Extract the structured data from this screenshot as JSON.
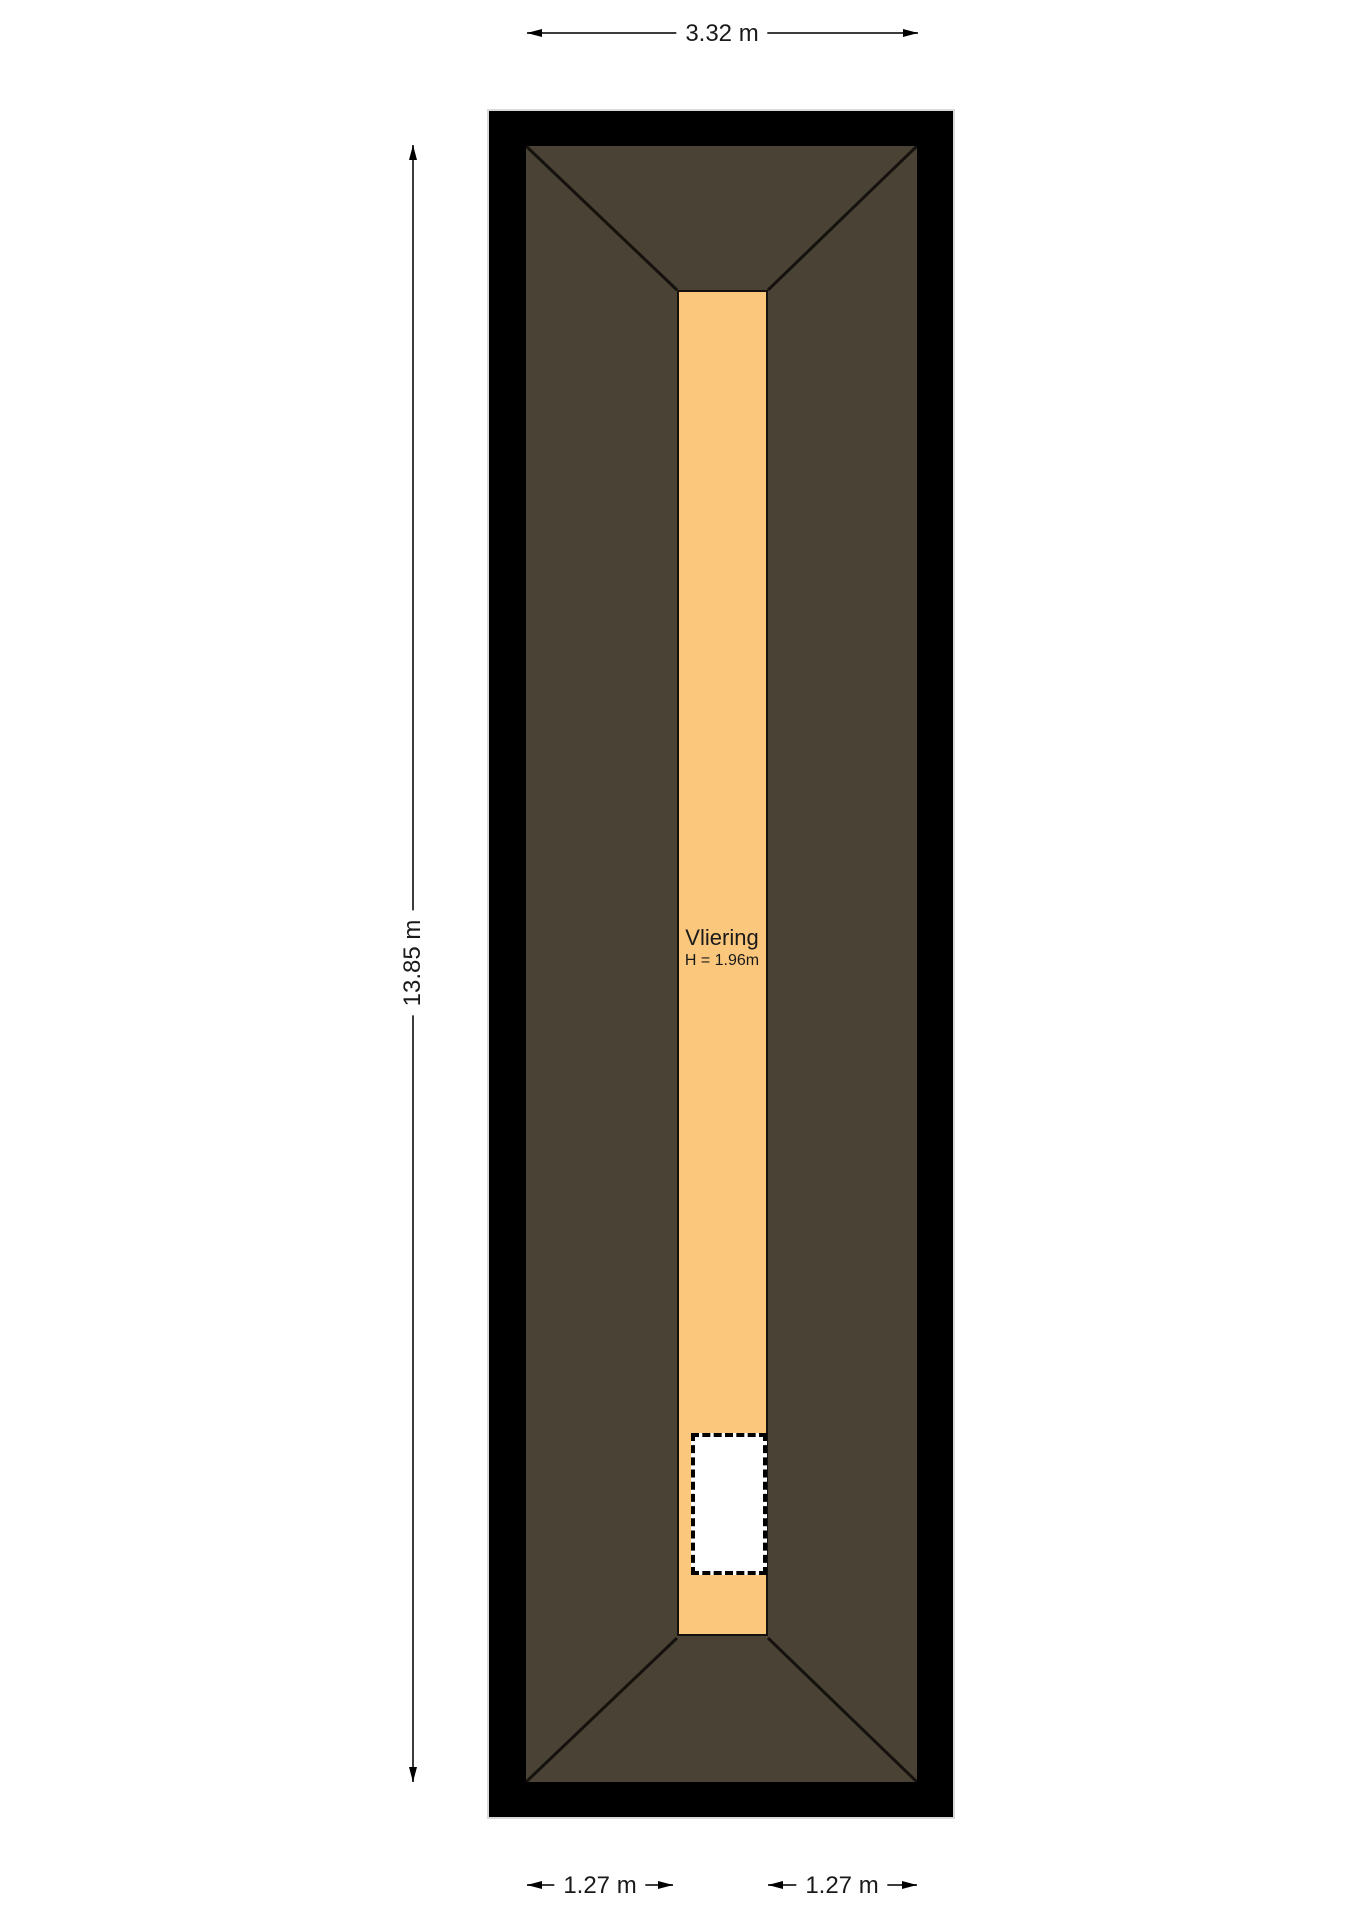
{
  "floorplan": {
    "room": {
      "name": "Vliering",
      "height": "H = 1.96m"
    },
    "dimensions": {
      "width_top": "3.32 m",
      "height_left": "13.85 m",
      "bottom_left": "1.27 m",
      "bottom_right": "1.27 m"
    },
    "colors": {
      "wall": "#000000",
      "roof": "#4a4234",
      "floor": "#fbc77d",
      "opening": "#ffffff",
      "dimline": "#3c3c3c",
      "arrow": "#000000",
      "text": "#1a1a1a"
    }
  }
}
